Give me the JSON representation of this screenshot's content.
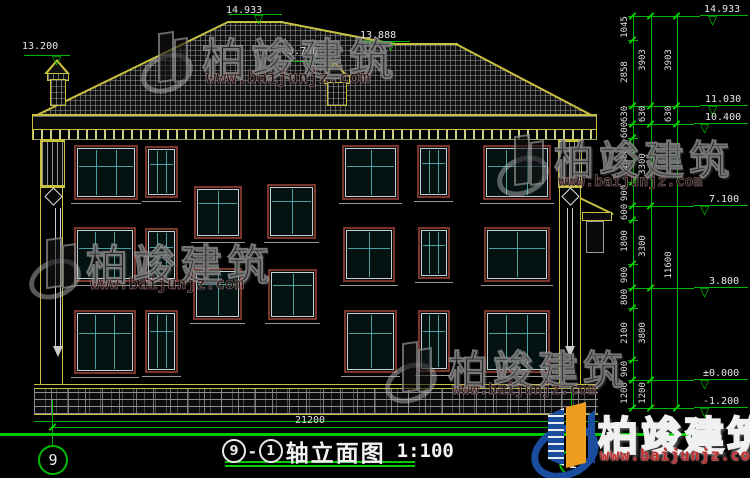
{
  "drawing": {
    "title": {
      "axis_start": "9",
      "axis_sep": "-",
      "axis_end": "1",
      "name": "轴立面图",
      "scale": "1:100"
    },
    "axis_bubbles": {
      "left": "9",
      "right": "1"
    },
    "elevations": [
      "13.200",
      "14.933",
      "13.888",
      "13.700",
      "14.933",
      "11.030",
      "10.400",
      "7.100",
      "3.800",
      "±0.000",
      "-1.200"
    ],
    "dims": {
      "chain_inner": [
        "1045",
        "2858",
        "630",
        "600",
        "1800",
        "900",
        "600",
        "1800",
        "900",
        "800",
        "2100",
        "900",
        "1200"
      ],
      "chain_mid": [
        "3903",
        "630",
        "3300",
        "3300",
        "3800",
        "1200"
      ],
      "chain_outer": [
        "3903",
        "630",
        "11600"
      ],
      "total_width": "21200"
    }
  },
  "watermark": {
    "brand": "柏竣建筑",
    "url": "www.baijunjz.com"
  },
  "logo": {
    "brand": "柏竣建筑",
    "url": "www.baijunjz.com"
  },
  "colors": {
    "line_green": "#00c000",
    "line_yellow": "#c8c040",
    "window_frame": "#7c352b",
    "mullion": "#49a0a0",
    "logo_blue": "#1b4d9e",
    "logo_orange": "#ef9d1e"
  }
}
